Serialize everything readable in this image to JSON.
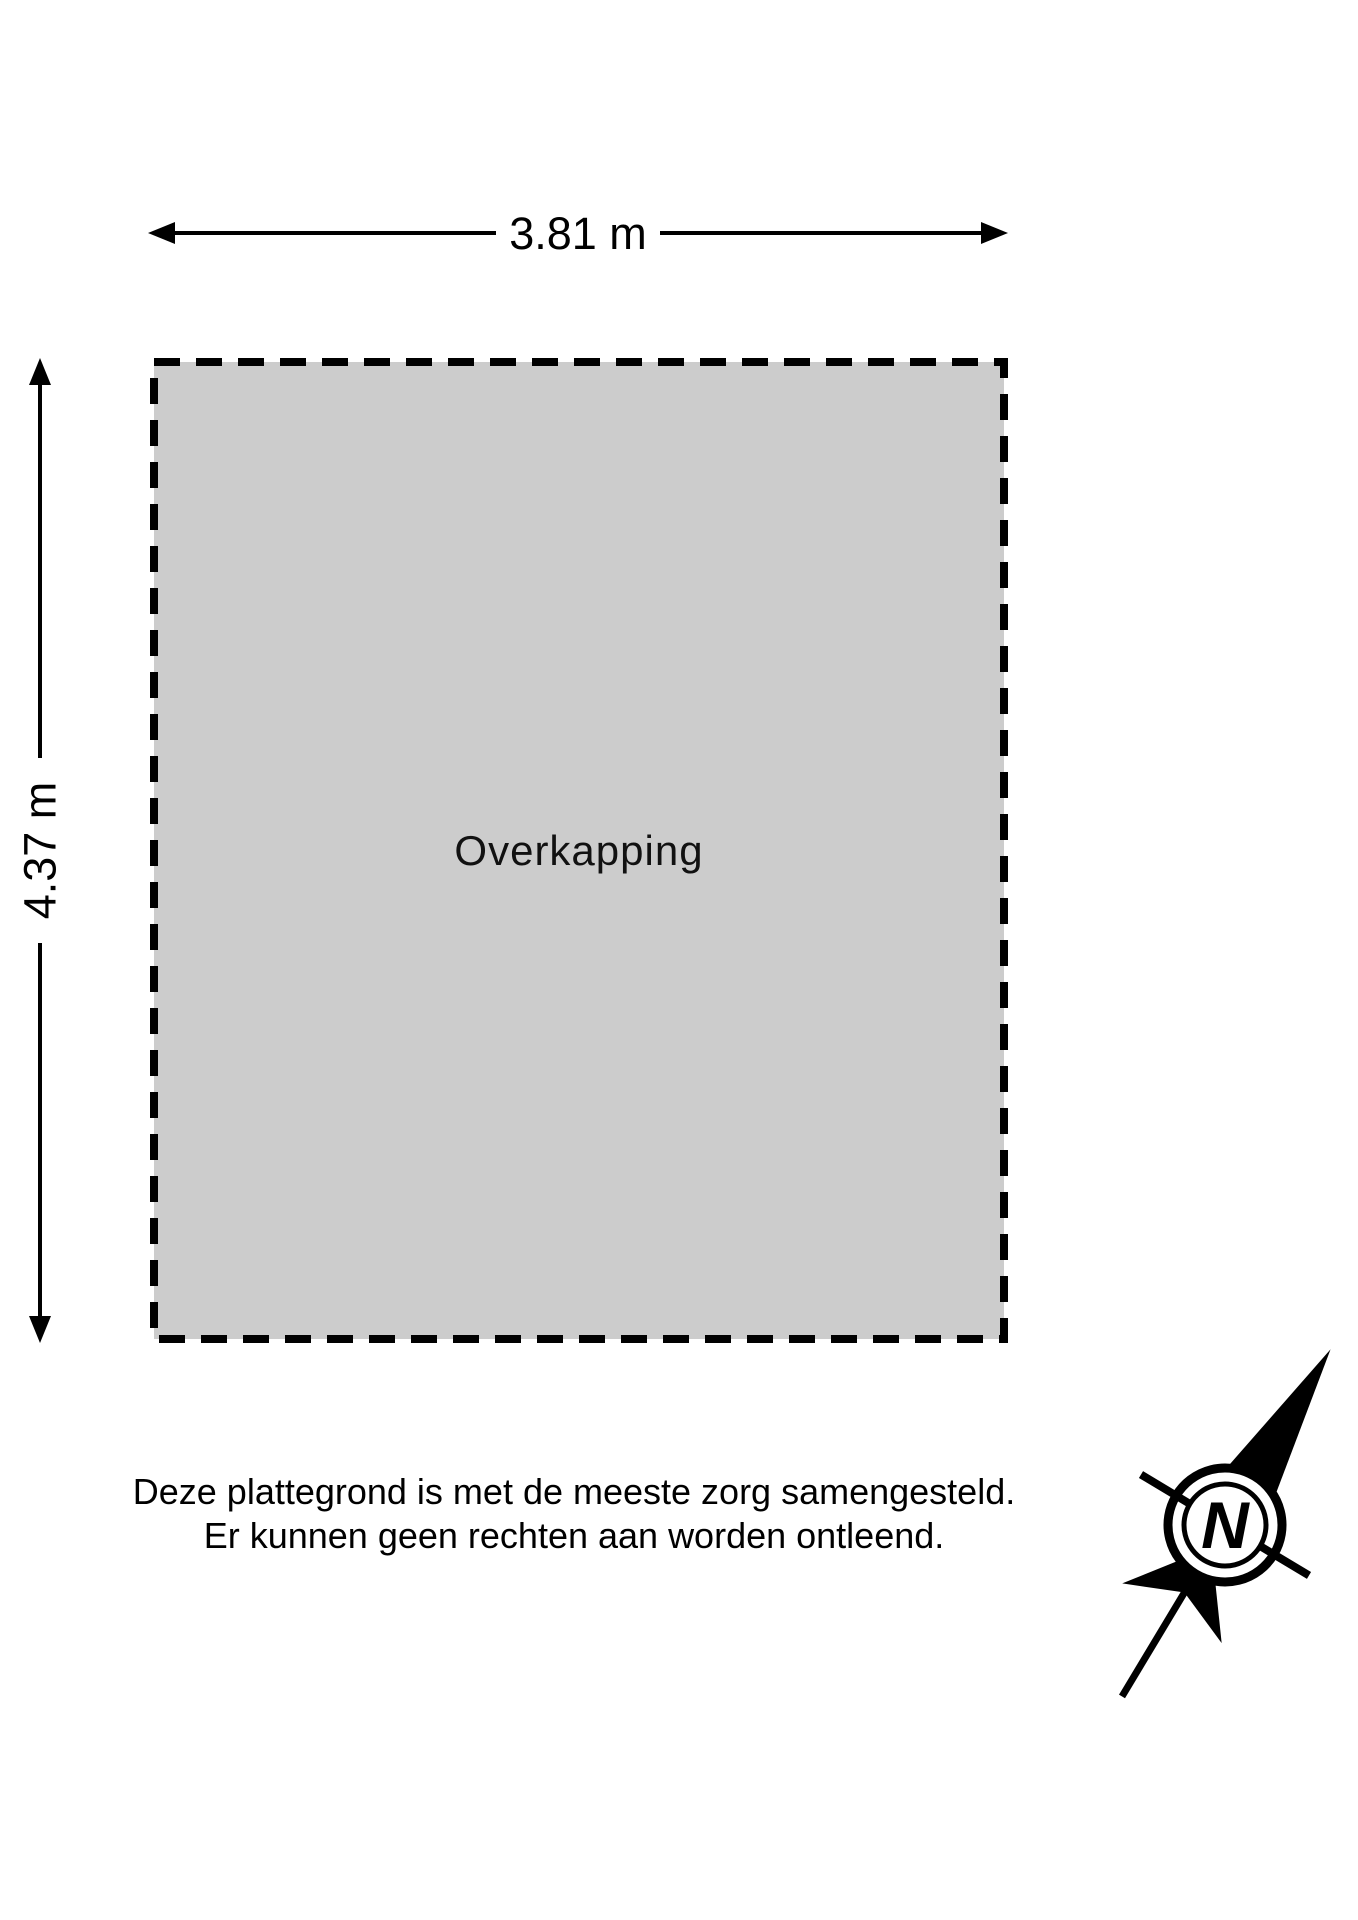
{
  "floorplan": {
    "room_label": "Overkapping",
    "width_label": "3.81 m",
    "height_label": "4.37 m",
    "room_fill": "#cccccc",
    "line_color": "#000000"
  },
  "disclaimer": {
    "line1": "Deze plattegrond is met de meeste zorg samengesteld.",
    "line2": "Er kunnen geen rechten aan worden ontleend."
  },
  "compass": {
    "icon": "north-compass-icon",
    "n_label": "N"
  }
}
